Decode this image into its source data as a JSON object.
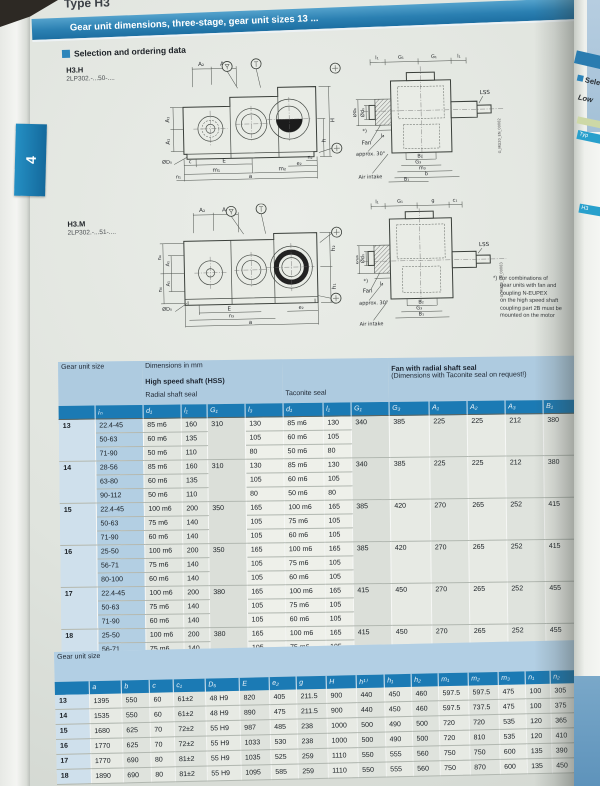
{
  "page": {
    "type_label": "Type H3",
    "title_bar": "Gear unit dimensions, three-stage, gear unit sizes 13 ...",
    "section_title": "Selection and ordering data",
    "side_tab": "4",
    "accent_color": "#2d85ba",
    "table_header_color": "#1b7ab4",
    "band_color": "#aecbe0"
  },
  "drawing_h3h": {
    "name": "H3.H",
    "code": "2LP302.-...50-....",
    "front": {
      "a2": "A₂",
      "a3": "A₃",
      "a1u": "A₁",
      "a1l": "A₁",
      "H": "H",
      "h": "h",
      "c": "c",
      "E": "E",
      "n2": "n₂",
      "e2": "e₂",
      "d5": "ØD₅",
      "n1": "n₁",
      "m1": "m₁",
      "m2": "m₂",
      "a": "a"
    },
    "side": {
      "l1a": "l₁",
      "g1a": "G₁",
      "g1b": "G₁",
      "l1b": "l₁",
      "d1": "Ød₁",
      "d6": "Ød₆",
      "star": "*)",
      "lss": "LSS",
      "fan": "Fan",
      "l3": "l₃",
      "b2": "B₂",
      "g3": "G₃",
      "m3": "m₃",
      "b": "b",
      "b1": "B₁",
      "approx": "approx. 30°",
      "air": "Air intake",
      "code": "G_MD20_EN_00082"
    }
  },
  "drawing_h3m": {
    "name": "H3.M",
    "code": "2LP302.-...51-....",
    "front": {
      "a2": "A₂",
      "a3": "A₃",
      "n4u": "n₄",
      "a1u": "A₁",
      "a1l": "A₁",
      "n4l": "n₄",
      "h2": "h₂",
      "h1": "h₁",
      "d5": "ØD₅",
      "E": "E",
      "e2": "e₂",
      "n3": "n₃",
      "a": "a"
    },
    "side": {
      "l1": "l₁",
      "g1": "G₁",
      "g": "g",
      "c1": "c₁",
      "d1": "Ød₁",
      "d6": "Ød₆",
      "star": "*)",
      "lss": "LSS",
      "fan": "Fan",
      "l3": "l₃",
      "b2": "B₂",
      "g3": "G₃",
      "b1": "B₁",
      "approx": "approx. 30°",
      "air": "Air intake",
      "code": "G_MD20_EN_00083"
    }
  },
  "footnote": [
    "*) For combinations of",
    "gear units with fan and",
    "coupling N-EUPEX",
    "on the high speed shaft",
    "coupling part 2B must be",
    "mounted on the motor"
  ],
  "main_table": {
    "size_label": "Gear unit size",
    "dim_note": "Dimensions in mm",
    "hss_label": "High speed shaft (HSS)",
    "radial_label": "Radial shaft seal",
    "taconite_label": "Taconite seal",
    "fan_label": "Fan with radial shaft seal",
    "fan_note": "(Dimensions with Taconite seal on request!)",
    "columns": [
      "iₙ",
      "d₁",
      "l₁",
      "G₁",
      "l₃",
      "d₁",
      "l₁",
      "G₁",
      "G₃",
      "A₁",
      "A₂",
      "A₃",
      "B₁",
      "B₂"
    ],
    "groups": [
      {
        "size": "13",
        "rows": [
          [
            "22.4-45",
            "85 m6",
            "160",
            "310",
            "130",
            "85 m6",
            "130",
            "340",
            "385",
            "225",
            "225",
            "212",
            "380",
            "195"
          ],
          [
            "50-63",
            "60 m6",
            "135",
            "105",
            "60 m6",
            "105"
          ],
          [
            "71-90",
            "50 m6",
            "110",
            "80",
            "50 m6",
            "80"
          ]
        ]
      },
      {
        "size": "14",
        "rows": [
          [
            "28-56",
            "85 m6",
            "160",
            "310",
            "130",
            "85 m6",
            "130",
            "340",
            "385",
            "225",
            "225",
            "212",
            "380",
            "195"
          ],
          [
            "63-80",
            "60 m6",
            "135",
            "105",
            "60 m6",
            "105"
          ],
          [
            "90-112",
            "50 m6",
            "110",
            "80",
            "50 m6",
            "80"
          ]
        ]
      },
      {
        "size": "15",
        "rows": [
          [
            "22.4-45",
            "100 m6",
            "200",
            "350",
            "165",
            "100 m6",
            "165",
            "385",
            "420",
            "270",
            "265",
            "252",
            "415",
            "205"
          ],
          [
            "50-63",
            "75 m6",
            "140",
            "105",
            "75 m6",
            "105"
          ],
          [
            "71-90",
            "60 m6",
            "140",
            "105",
            "60 m6",
            "105"
          ]
        ]
      },
      {
        "size": "16",
        "rows": [
          [
            "25-50",
            "100 m6",
            "200",
            "350",
            "165",
            "100 m6",
            "165",
            "385",
            "420",
            "270",
            "265",
            "252",
            "415",
            "205"
          ],
          [
            "56-71",
            "75 m6",
            "140",
            "105",
            "75 m6",
            "105"
          ],
          [
            "80-100",
            "60 m6",
            "140",
            "105",
            "60 m6",
            "105"
          ]
        ]
      },
      {
        "size": "17",
        "rows": [
          [
            "22.4-45",
            "100 m6",
            "200",
            "380",
            "165",
            "100 m6",
            "165",
            "415",
            "450",
            "270",
            "265",
            "252",
            "455",
            "235"
          ],
          [
            "50-63",
            "75 m6",
            "140",
            "105",
            "75 m6",
            "105"
          ],
          [
            "71-90",
            "60 m6",
            "140",
            "105",
            "60 m6",
            "105"
          ]
        ]
      },
      {
        "size": "18",
        "rows": [
          [
            "25-50",
            "100 m6",
            "200",
            "380",
            "165",
            "100 m6",
            "165",
            "415",
            "450",
            "270",
            "265",
            "252",
            "455",
            "235"
          ],
          [
            "56-71",
            "75 m6",
            "140",
            "105",
            "75 m6",
            "105"
          ],
          [
            "80-100",
            "60 m6",
            "140",
            "105",
            "60 m6",
            "105"
          ]
        ]
      }
    ]
  },
  "dim_table": {
    "size_label": "Gear unit size",
    "columns": [
      "a",
      "b",
      "c",
      "c₁",
      "D₅",
      "E",
      "e₂",
      "g",
      "H",
      "h¹⁾",
      "h₁",
      "h₂",
      "m₁",
      "m₂",
      "m₃",
      "n₁",
      "n₂",
      "n₃",
      "n₄"
    ],
    "rows": [
      [
        "13",
        "1395",
        "550",
        "60",
        "61±2",
        "48 H9",
        "820",
        "405",
        "211.5",
        "900",
        "440",
        "450",
        "460",
        "597.5",
        "597.5",
        "475",
        "100",
        "305",
        "940",
        "340"
      ],
      [
        "14",
        "1535",
        "550",
        "60",
        "61±2",
        "48 H9",
        "890",
        "475",
        "211.5",
        "900",
        "440",
        "450",
        "460",
        "597.5",
        "737.5",
        "475",
        "100",
        "375",
        "1010",
        "340"
      ],
      [
        "15",
        "1680",
        "625",
        "70",
        "72±2",
        "55 H9",
        "987",
        "485",
        "238",
        "1000",
        "500",
        "490",
        "500",
        "720",
        "720",
        "535",
        "120",
        "365",
        "1135",
        "375"
      ],
      [
        "16",
        "1770",
        "625",
        "70",
        "72±2",
        "55 H9",
        "1033",
        "530",
        "238",
        "1000",
        "500",
        "490",
        "500",
        "720",
        "810",
        "535",
        "120",
        "410",
        "1180",
        "375"
      ],
      [
        "17",
        "1770",
        "690",
        "80",
        "81±2",
        "55 H9",
        "1035",
        "525",
        "259",
        "1110",
        "550",
        "555",
        "560",
        "750",
        "750",
        "600",
        "135",
        "390",
        "1175",
        "405"
      ],
      [
        "18",
        "1890",
        "690",
        "80",
        "81±2",
        "55 H9",
        "1095",
        "585",
        "259",
        "1110",
        "550",
        "555",
        "560",
        "750",
        "870",
        "600",
        "135",
        "450",
        "1235",
        "405"
      ]
    ]
  },
  "adjacent_page": [
    "Sele",
    "Low",
    "Typ",
    "H3"
  ]
}
